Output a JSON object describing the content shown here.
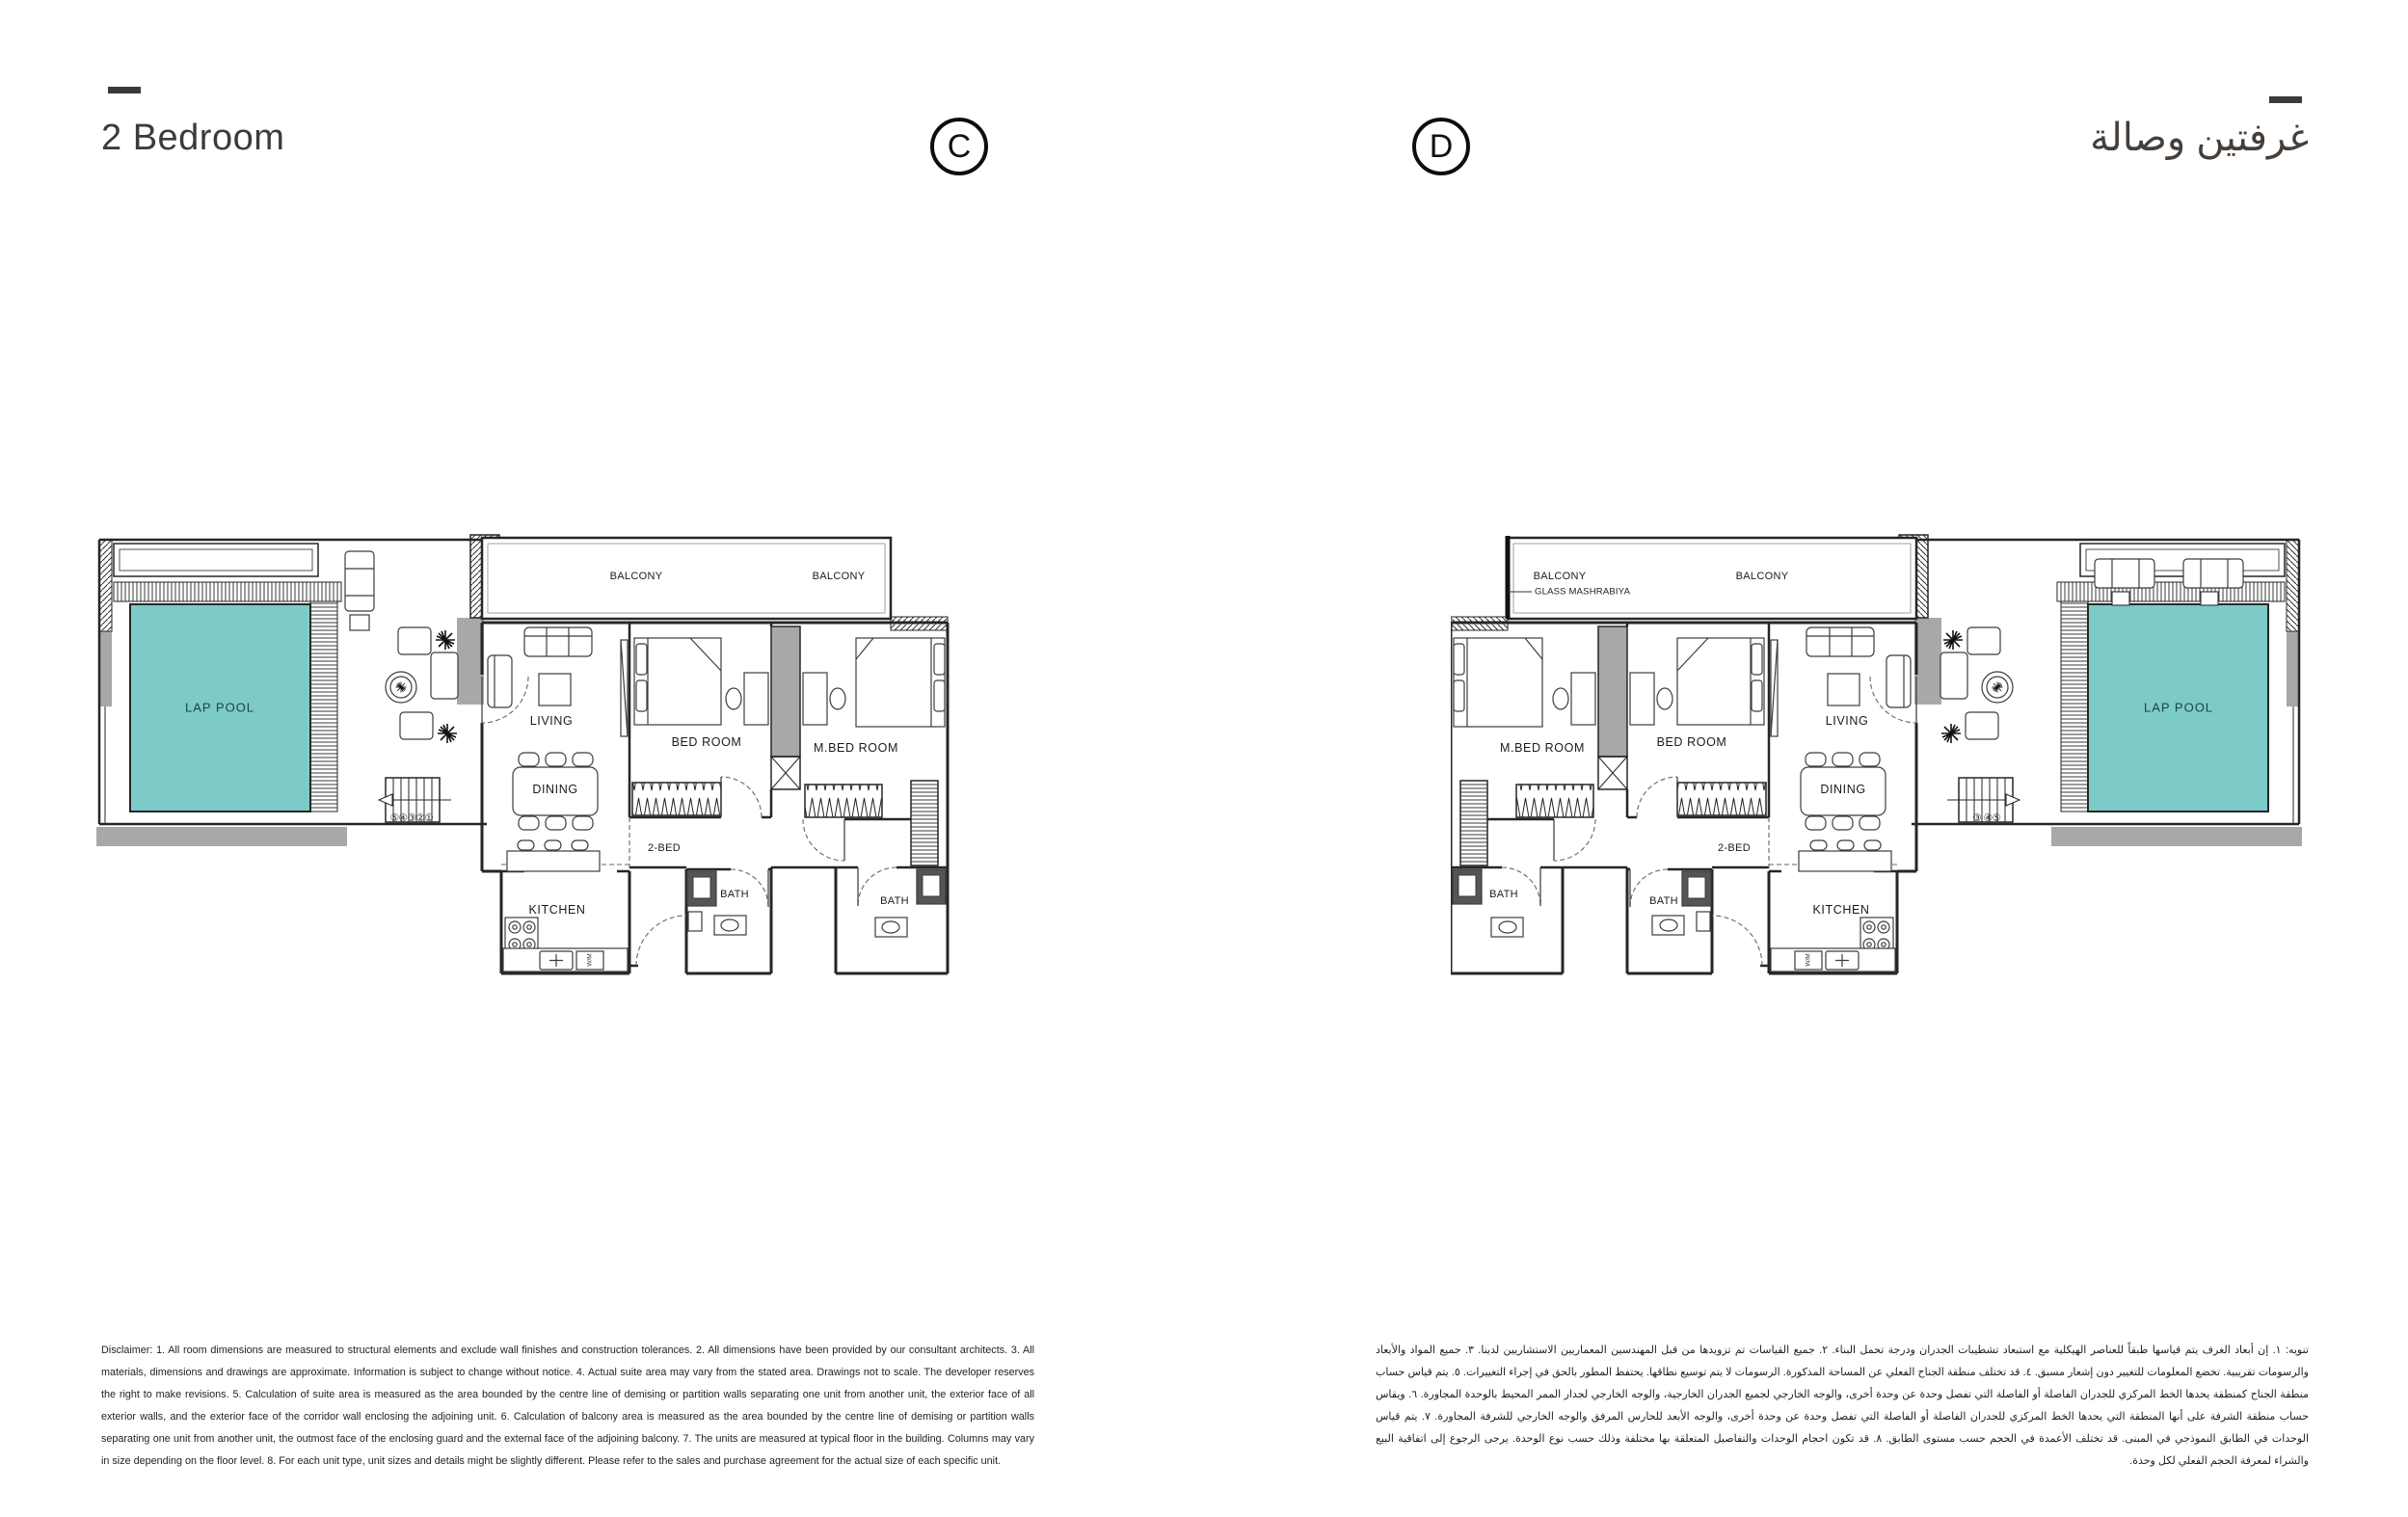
{
  "header": {
    "title_en": "2 Bedroom",
    "title_ar": "غرفتين وصالة",
    "unit_c": "C",
    "unit_d": "D"
  },
  "labels": {
    "lap_pool": "LAP POOL",
    "balcony": "BALCONY",
    "living": "LIVING",
    "dining": "DINING",
    "kitchen": "KITCHEN",
    "bed_room": "BED ROOM",
    "m_bed_room": "M.BED ROOM",
    "bath": "BATH",
    "two_bed": "2-BED",
    "glass_mashrabiya": "GLASS MASHRABIYA",
    "wm": "W/M",
    "stairs_c": "⑤④③②①",
    "stairs_d": "③ ④⑤"
  },
  "colors": {
    "pool": "#7DCBC8"
  },
  "disclaimer_en": "Disclaimer: 1. All room dimensions are measured to structural elements and exclude wall finishes and construction tolerances. 2. All dimensions have been provided by our consultant architects. 3. All materials, dimensions and drawings are approximate. Information is subject to change without notice. 4. Actual suite area may vary from the stated area. Drawings not to scale. The developer reserves the right to make revisions. 5. Calculation of suite area is measured as the area bounded by the centre line of demising or partition walls separating one unit from another unit, the exterior face of all exterior walls, and the exterior face of the corridor wall enclosing the adjoining unit. 6. Calculation of balcony area is measured as the area bounded by the centre line of demising or partition walls separating one unit from another unit, the outmost face of the enclosing guard and the external face of the adjoining balcony. 7. The units are measured at typical floor in the building. Columns may vary in size depending on the floor level. 8. For each unit type, unit sizes and details might be slightly different. Please refer to the sales and purchase agreement for the actual size of each specific unit.",
  "disclaimer_ar": "تنويه: ١. إن أبعاد الغرف يتم قياسها طبقاً للعناصر الهيكلية مع استبعاد تشطيبات الجدران ودرجة تحمل البناء. ٢. جميع القياسات تم تزويدها من قبل المهندسين المعماريين الاستشاريين لدينا. ٣. جميع المواد والأبعاد والرسومات تقريبية. تخضع المعلومات للتغيير دون إشعار مسبق. ٤. قد تختلف منطقة الجناح الفعلي عن المساحة المذكورة. الرسومات لا يتم توسيع نطاقها. يحتفظ المطور بالحق في إجراء التغييرات. ٥. يتم قياس حساب منطقة الجناح كمنطقة يحدها الخط المركزي للجدران الفاصلة أو الفاصلة التي تفصل وحدة عن وحدة أخرى، والوجه الخارجي لجميع الجدران الخارجية، والوجه الخارجي لجدار الممر المحيط بالوحدة المجاورة. ٦. ويقاس حساب منطقة الشرفة على أنها المنطقة التي يحدها الخط المركزي للجدران الفاصلة أو الفاصلة التي تفصل وحدة عن وحدة أخرى، والوجه الأبعد للحارس المرفق والوجه الخارجي للشرفة المجاورة. ٧. يتم قياس الوحدات في الطابق النموذجي في المبنى. قد تختلف الأعمدة في الحجم حسب مستوى الطابق. ٨. قد تكون احجام الوحدات والتفاصيل المتعلقة بها مختلفة وذلك حسب نوع الوحدة. يرجى الرجوع إلى اتفاقية البيع والشراء لمعرفة الحجم الفعلي لكل وحدة."
}
